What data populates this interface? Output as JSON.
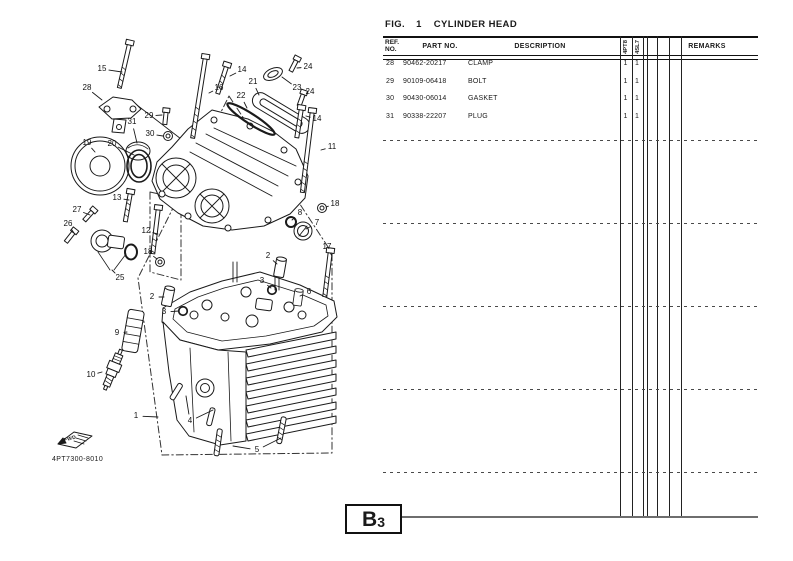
{
  "header": {
    "fig_label": "FIG.",
    "fig_no": "1",
    "title": "CYLINDER HEAD"
  },
  "table": {
    "col_ref_line1": "REF.",
    "col_ref_line2": "NO.",
    "col_part": "PART NO.",
    "col_desc": "DESCRIPTION",
    "col_remarks": "REMARKS",
    "model_codes": [
      "4PT8",
      "4SL7"
    ],
    "rows": [
      {
        "ref": "28",
        "part": "90462-20217",
        "desc": "CLAMP",
        "q1": "1",
        "q2": "1"
      },
      {
        "ref": "29",
        "part": "90109-06418",
        "desc": "BOLT",
        "q1": "1",
        "q2": "1"
      },
      {
        "ref": "30",
        "part": "90430-06014",
        "desc": "GASKET",
        "q1": "1",
        "q2": "1"
      },
      {
        "ref": "31",
        "part": "90338-22207",
        "desc": "PLUG",
        "q1": "1",
        "q2": "1"
      }
    ]
  },
  "figure": {
    "drawing_code": "4PT7300-8010",
    "fwd_label": "FWD",
    "callouts": [
      {
        "n": "1",
        "x": 136,
        "y": 416,
        "lx": 158,
        "ly": 417
      },
      {
        "n": "2",
        "x": 152,
        "y": 297,
        "lx": 164,
        "ly": 297
      },
      {
        "n": "2",
        "x": 268,
        "y": 256,
        "lx": 277,
        "ly": 264
      },
      {
        "n": "3",
        "x": 164,
        "y": 312,
        "lx": 179,
        "ly": 311
      },
      {
        "n": "3",
        "x": 262,
        "y": 281,
        "lx": 271,
        "ly": 288
      },
      {
        "n": "4",
        "x": 190,
        "y": 421,
        "lx": 213,
        "ly": 410,
        "lx2": 186,
        "ly2": 396
      },
      {
        "n": "5",
        "x": 257,
        "y": 450,
        "lx": 233,
        "ly": 446,
        "lx2": 281,
        "ly2": 438
      },
      {
        "n": "6",
        "x": 309,
        "y": 292,
        "lx": 300,
        "ly": 296
      },
      {
        "n": "7",
        "x": 317,
        "y": 223,
        "lx": 306,
        "ly": 229
      },
      {
        "n": "8",
        "x": 300,
        "y": 213,
        "lx": 292,
        "ly": 220
      },
      {
        "n": "9",
        "x": 117,
        "y": 333,
        "lx": 127,
        "ly": 332
      },
      {
        "n": "10",
        "x": 91,
        "y": 375,
        "lx": 102,
        "ly": 372
      },
      {
        "n": "11",
        "x": 332,
        "y": 147,
        "lx": 321,
        "ly": 150
      },
      {
        "n": "12",
        "x": 146,
        "y": 231,
        "lx": 158,
        "ly": 234
      },
      {
        "n": "13",
        "x": 117,
        "y": 198,
        "lx": 129,
        "ly": 200
      },
      {
        "n": "14",
        "x": 242,
        "y": 70,
        "lx": 230,
        "ly": 76
      },
      {
        "n": "14",
        "x": 317,
        "y": 119,
        "lx": 306,
        "ly": 116
      },
      {
        "n": "15",
        "x": 102,
        "y": 69,
        "lx": 122,
        "ly": 72
      },
      {
        "n": "16",
        "x": 219,
        "y": 88,
        "lx": 209,
        "ly": 93
      },
      {
        "n": "17",
        "x": 327,
        "y": 247,
        "lx": 332,
        "ly": 256
      },
      {
        "n": "18",
        "x": 335,
        "y": 204,
        "lx": 326,
        "ly": 207
      },
      {
        "n": "18",
        "x": 148,
        "y": 252,
        "lx": 157,
        "ly": 259
      },
      {
        "n": "19",
        "x": 87,
        "y": 143,
        "lx": 95,
        "ly": 152
      },
      {
        "n": "20",
        "x": 112,
        "y": 144,
        "lx": 134,
        "ly": 155
      },
      {
        "n": "21",
        "x": 253,
        "y": 82,
        "lx": 259,
        "ly": 95
      },
      {
        "n": "22",
        "x": 241,
        "y": 96,
        "lx": 247,
        "ly": 108
      },
      {
        "n": "23",
        "x": 297,
        "y": 88,
        "lx": 282,
        "ly": 77
      },
      {
        "n": "24",
        "x": 308,
        "y": 67,
        "lx": 297,
        "ly": 68
      },
      {
        "n": "24",
        "x": 310,
        "y": 92,
        "lx": 304,
        "ly": 97
      },
      {
        "n": "25",
        "x": 120,
        "y": 278,
        "lx": 112,
        "ly": 270
      },
      {
        "n": "26",
        "x": 68,
        "y": 224,
        "lx": 74,
        "ly": 233
      },
      {
        "n": "27",
        "x": 77,
        "y": 210,
        "lx": 90,
        "ly": 215
      },
      {
        "n": "28",
        "x": 87,
        "y": 88,
        "lx": 102,
        "ly": 100
      },
      {
        "n": "29",
        "x": 149,
        "y": 116,
        "lx": 162,
        "ly": 115
      },
      {
        "n": "30",
        "x": 150,
        "y": 134,
        "lx": 163,
        "ly": 136
      },
      {
        "n": "31",
        "x": 132,
        "y": 122,
        "lx": 137,
        "ly": 143
      }
    ]
  },
  "footer": {
    "page_ref_main": "B",
    "page_ref_sub": "3"
  },
  "colors": {
    "ink": "#1a1a1a",
    "rule": "#111111",
    "connector_gray": "#6e6e6e"
  }
}
